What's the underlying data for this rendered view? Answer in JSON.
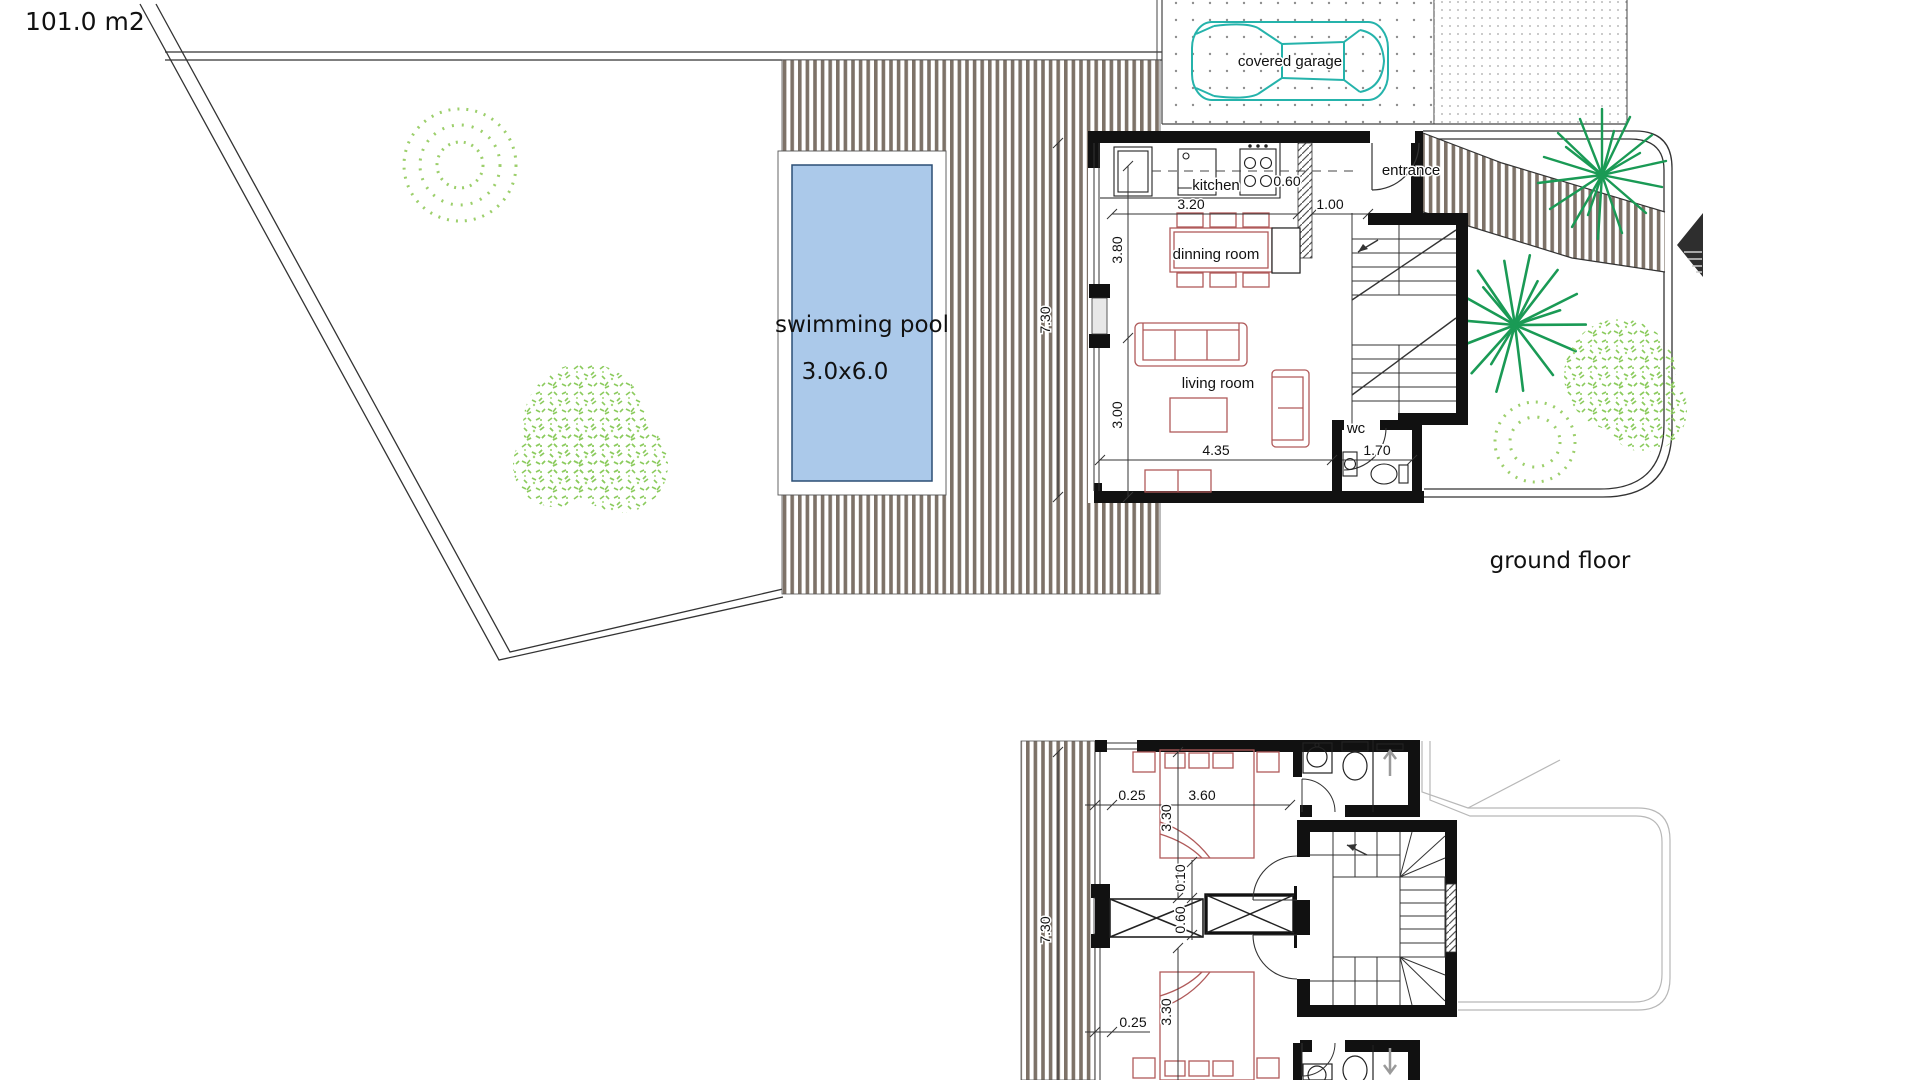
{
  "labels": {
    "area": "101.0 m2",
    "garage": "covered garage",
    "ground_title": "ground floor",
    "entrance": "entrance",
    "kitchen": "kitchen",
    "dining": "dinning room",
    "living": "living room",
    "wc": "wc",
    "pool_name": "swimming pool",
    "pool_size": "3.0x6.0"
  },
  "gdims": {
    "kitchen_w": "3.20",
    "passage": "0.60",
    "hall": "1.00",
    "dining_h": "3.80",
    "living_h": "3.00",
    "deck_h": "7.30",
    "living_w": "4.35",
    "wc_w": "1.70"
  },
  "fdims": {
    "deck_h": "7.30",
    "off_top": "0.25",
    "bed_w": "3.60",
    "bed1_h": "3.30",
    "gap": "0.10",
    "wardrobe": "0.60",
    "off_bottom": "0.25",
    "bed2_h": "3.30"
  },
  "colors": {
    "deck": "#7d7268",
    "pool": "#abc9ea",
    "furniture": "#b05a5a",
    "car": "#25b3ab",
    "palm": "#1a9a55",
    "shrub": "#9ccf6b",
    "wall": "#111111"
  }
}
